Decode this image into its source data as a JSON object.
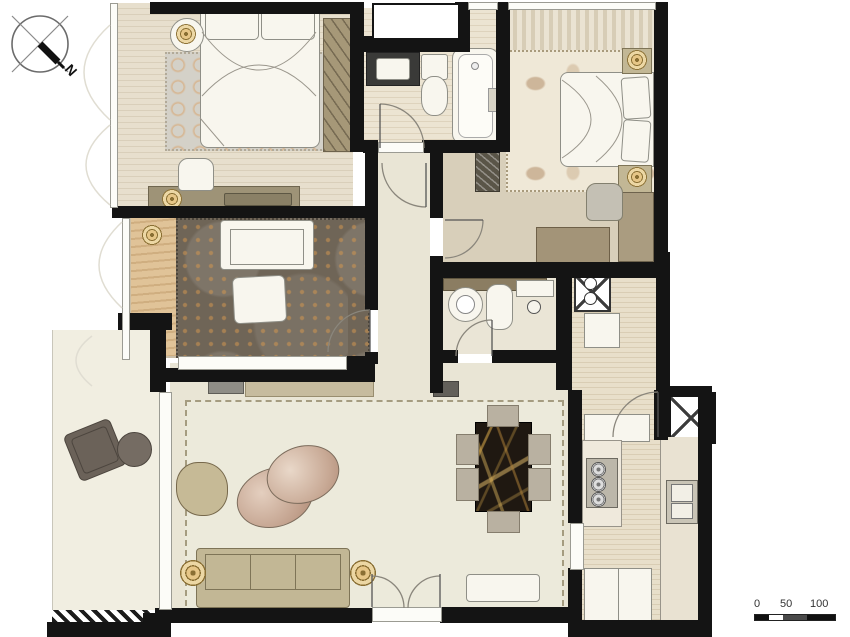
{
  "figure": {
    "kind": "apartment-floor-plan",
    "compass": {
      "label": "N"
    },
    "scale_bar": {
      "tick_labels": [
        "0",
        "50",
        "100"
      ]
    },
    "palette": {
      "wall": "#141414",
      "floor_cream": "#e9e5d5",
      "floor_wood_light": "#ddd3bf",
      "floor_wood_plank": "#d8bd8e",
      "rug_bedroom_gray": "#d4d1c8",
      "rug_ring_accent": "#d8a46e",
      "rug_study_dark": "#6f6557",
      "rug_master_cream": "#efe8d7",
      "rug_living": "#eceadb",
      "furniture_tan": "#c2b795",
      "furniture_gray": "#b9b1a1",
      "fixture_white": "#f8f6ee",
      "vanity_dark": "#3a3a38",
      "marble_black": "#1f1811",
      "marble_gold_vein": "#cea046",
      "gold_lamp": "#e6c687",
      "balcony_furniture_dark": "#6b6259",
      "pouf_gradient_light": "#e2cdbd",
      "pouf_gradient_dark": "#ac8874"
    },
    "icons": [
      "compass-north-icon",
      "scale-bar-icon",
      "shaft-x-icon",
      "washing-machine-icon",
      "gas-stove-icon",
      "double-sink-icon",
      "round-sink-icon",
      "toilet-icon",
      "bathtub-icon",
      "shower-icon",
      "gold-lamp-icon",
      "plant-icon",
      "door-swing-arc"
    ]
  }
}
